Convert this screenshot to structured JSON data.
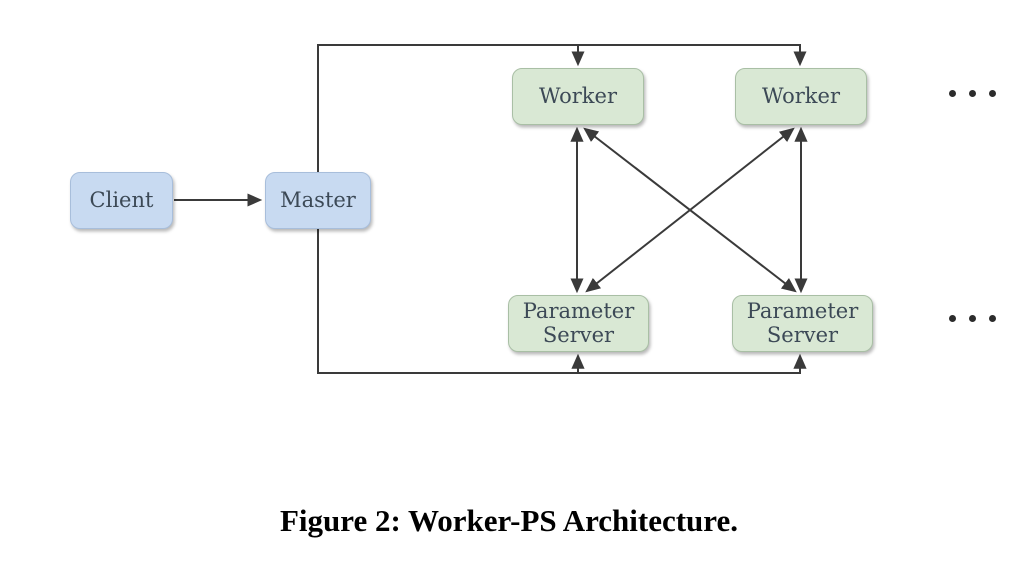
{
  "diagram": {
    "caption": "Figure 2: Worker-PS Architecture.",
    "nodes": {
      "client": {
        "label": "Client",
        "role": "client",
        "fill": "#c8daf1"
      },
      "master": {
        "label": "Master",
        "role": "master",
        "fill": "#c8daf1"
      },
      "worker_1": {
        "label": "Worker",
        "role": "worker",
        "fill": "#d9e8d4"
      },
      "worker_2": {
        "label": "Worker",
        "role": "worker",
        "fill": "#d9e8d4"
      },
      "ps_1": {
        "label": "Parameter Server",
        "role": "parameter-server",
        "fill": "#d9e8d4"
      },
      "ps_2": {
        "label": "Parameter Server",
        "role": "parameter-server",
        "fill": "#d9e8d4"
      }
    },
    "edges": [
      {
        "from": "client",
        "to": "master",
        "bidirectional": false
      },
      {
        "from": "master",
        "to": "worker_1",
        "bidirectional": false
      },
      {
        "from": "master",
        "to": "worker_2",
        "bidirectional": false
      },
      {
        "from": "master",
        "to": "ps_1",
        "bidirectional": false
      },
      {
        "from": "master",
        "to": "ps_2",
        "bidirectional": false
      },
      {
        "from": "worker_1",
        "to": "ps_1",
        "bidirectional": true
      },
      {
        "from": "worker_1",
        "to": "ps_2",
        "bidirectional": true
      },
      {
        "from": "worker_2",
        "to": "ps_1",
        "bidirectional": true
      },
      {
        "from": "worker_2",
        "to": "ps_2",
        "bidirectional": true
      }
    ],
    "more_indicators": {
      "workers_row": "horizontal-ellipsis",
      "servers_row": "horizontal-ellipsis"
    },
    "colors": {
      "background": "#ffffff",
      "client_master_fill": "#c8daf1",
      "worker_ps_fill": "#d9e8d4",
      "node_text": "#3c4956",
      "connector": "#3a3a3a",
      "caption_text": "#000000"
    }
  }
}
